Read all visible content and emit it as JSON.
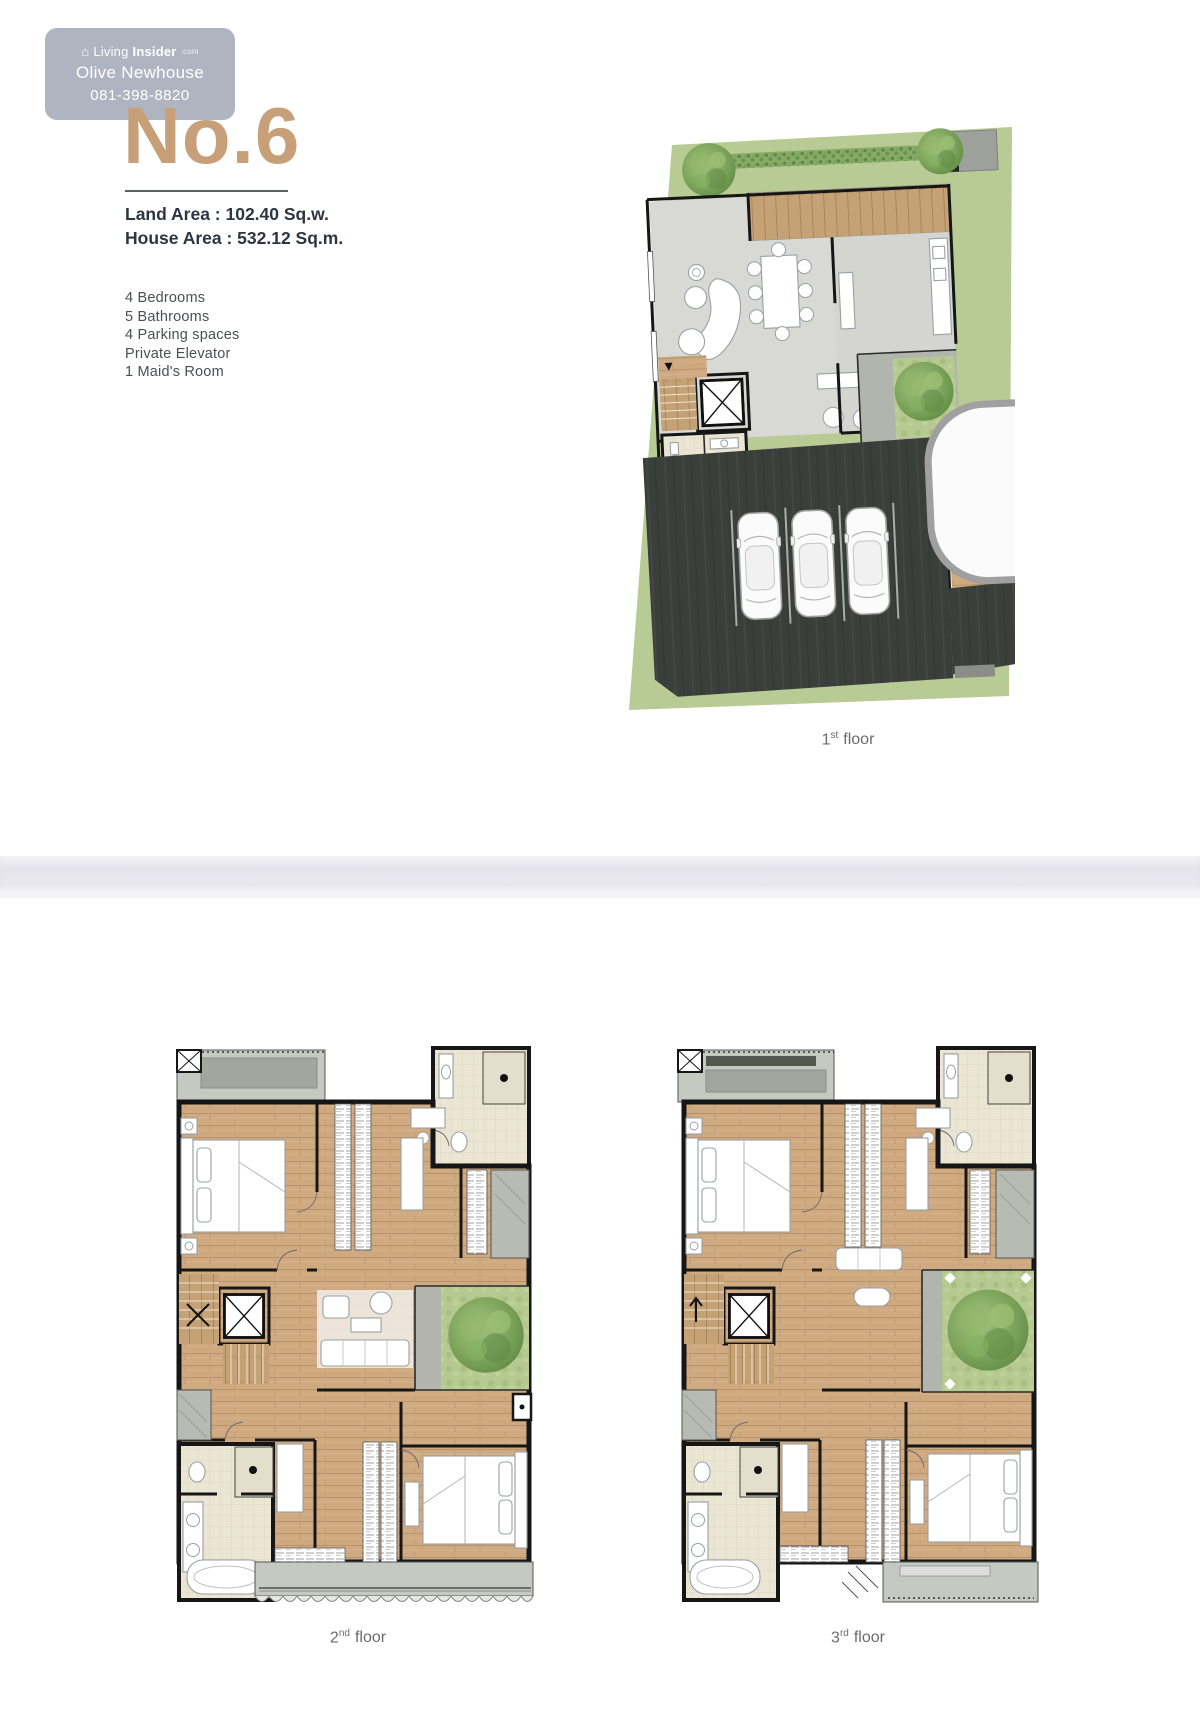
{
  "watermark": {
    "brand": {
      "prefix": "Living",
      "suffix": "Insider",
      "tld": ".com"
    },
    "agent_name": "Olive Newhouse",
    "phone": "081-398-8820"
  },
  "listing": {
    "unit_number": "No.6",
    "land_area": "Land Area : 102.40 Sq.w.",
    "house_area": "House Area : 532.12 Sq.m."
  },
  "features": [
    "4 Bedrooms",
    "5 Bathrooms",
    "4 Parking spaces",
    "Private Elevator",
    "1 Maid's Room"
  ],
  "floor_labels": {
    "first": {
      "number": "1",
      "ordinal": "st",
      "word": "floor"
    },
    "second": {
      "number": "2",
      "ordinal": "nd",
      "word": "floor"
    },
    "third": {
      "number": "3",
      "ordinal": "rd",
      "word": "floor"
    }
  },
  "colors": {
    "accent_tan": "#c7a07a",
    "wall_black": "#161616",
    "wood_floor": "#cfa980",
    "grass_green": "#b8cb95",
    "parking_dark": "#3b3f3b",
    "balcony_gray": "#c6c8c2",
    "tile_beige": "#ebe5d4",
    "watermark_bg": "#9ea3b2",
    "divider_band": "#e8e7f0",
    "text_dark": "#2e3440",
    "text_gray": "#4b4f55",
    "label_gray": "#6b6b6b"
  }
}
